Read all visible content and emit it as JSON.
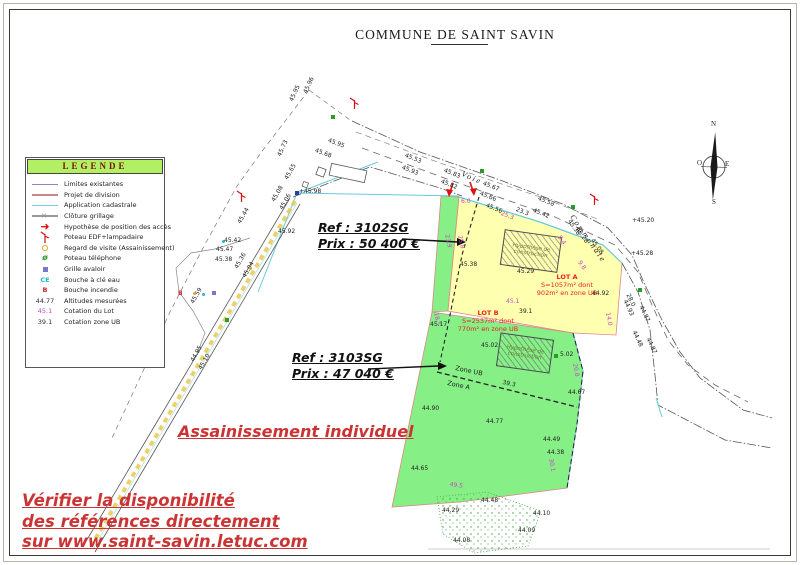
{
  "title": "COMMUNE DE SAINT SAVIN",
  "colors": {
    "lot_a_fill": "#ffffb0",
    "lot_b_fill": "#86ef86",
    "legend_header_bg": "#b2ef62",
    "annotation_red": "#cc3333",
    "lot_label_red": "#ee2020",
    "dimension_magenta": "#c44ac4",
    "cadastre_cyan": "#66ccdd",
    "division_pink": "#dd8888"
  },
  "legend": {
    "header": "LEGENDE",
    "items": [
      {
        "label": "Limites existantes",
        "symbol": "line",
        "color": "#8888bb"
      },
      {
        "label": "Projet de division",
        "symbol": "line",
        "color": "#cc8888"
      },
      {
        "label": "Application cadastrale",
        "symbol": "line",
        "color": "#7accd6"
      },
      {
        "label": "Clôture grillage",
        "symbol": "fence",
        "color": "#999999"
      },
      {
        "label": "Hypothèse de position des accès",
        "symbol": "arrow",
        "color": "#dd1111"
      },
      {
        "label": "Poteau EDF+lampadaire",
        "symbol": "pole",
        "color": "#dd1111"
      },
      {
        "label": "Regard de visite (Assainissement)",
        "symbol": "circle",
        "color": "#d9a927"
      },
      {
        "label": "Poteau téléphone",
        "symbol": "phone-pole",
        "color": "#2a9a2a"
      },
      {
        "label": "Grille avaloir",
        "symbol": "square",
        "color": "#7878cc"
      },
      {
        "label": "Bouche à clé eau",
        "symbol": "text-CE",
        "color": "#22b6cc",
        "glyph": "CE"
      },
      {
        "label": "Bouche incendie",
        "symbol": "hydrant",
        "color": "#cc2222",
        "glyph": "B"
      },
      {
        "label": "Altitudes mesurées",
        "symbol": "text",
        "color": "#333333",
        "glyph": "44.77"
      },
      {
        "label": "Cotation du Lot",
        "symbol": "text",
        "color": "#c44ac4",
        "glyph": "45.1"
      },
      {
        "label": "Cotation zone UB",
        "symbol": "text",
        "color": "#333333",
        "glyph": "39.1"
      }
    ]
  },
  "annotations": {
    "ref_a": {
      "ref": "Ref : 3102SG",
      "price": "Prix : 50 400 €"
    },
    "ref_b": {
      "ref": "Ref : 3103SG",
      "price": "Prix : 47 040 €"
    },
    "sanitation": "Assainissement individuel",
    "disclaimer_lines": [
      "Vérifier la disponibilité",
      "des références directement",
      "sur www.saint-savin.letuc.com"
    ]
  },
  "lots": {
    "lot_a": {
      "name": "LOT A",
      "line2": "S=1057m² dont",
      "line3": "902m² en zone UB"
    },
    "lot_b": {
      "name": "LOT B",
      "line2": "S=2537m² dont",
      "line3": "770m² en zone UB"
    },
    "construction_label": "Hypothèse de construction"
  },
  "map": {
    "labels": [
      {
        "t": "45.95",
        "x": 289,
        "y": 100,
        "r": -65
      },
      {
        "t": "45.96",
        "x": 303,
        "y": 92,
        "r": -65
      },
      {
        "t": "45.73",
        "x": 277,
        "y": 155,
        "r": -65
      },
      {
        "t": "45.68",
        "x": 316,
        "y": 148,
        "r": 20
      },
      {
        "t": "45.95",
        "x": 329,
        "y": 138,
        "r": 20
      },
      {
        "t": "45.53",
        "x": 406,
        "y": 153,
        "r": 22
      },
      {
        "t": "45.93",
        "x": 403,
        "y": 165,
        "r": 22
      },
      {
        "t": "45.83",
        "x": 445,
        "y": 168,
        "r": 22
      },
      {
        "t": "45.82",
        "x": 442,
        "y": 179,
        "r": 22
      },
      {
        "t": "45.67",
        "x": 484,
        "y": 181,
        "r": 22
      },
      {
        "t": "45.66",
        "x": 481,
        "y": 191,
        "r": 22
      },
      {
        "t": "45.58",
        "x": 539,
        "y": 196,
        "r": 22
      },
      {
        "t": "45.42",
        "x": 534,
        "y": 208,
        "r": 22
      },
      {
        "t": "23.3",
        "x": 517,
        "y": 207,
        "r": 22
      },
      {
        "t": "25.3",
        "x": 502,
        "y": 211,
        "r": 22,
        "c": "m"
      },
      {
        "t": "45.56",
        "x": 487,
        "y": 203,
        "r": 22
      },
      {
        "t": "6.0",
        "x": 461,
        "y": 199,
        "r": 0,
        "c": "m"
      },
      {
        "t": "Voie",
        "x": 463,
        "y": 171,
        "r": 24,
        "cls": "road"
      },
      {
        "t": "Communale",
        "x": 574,
        "y": 214,
        "r": 55,
        "cls": "road"
      },
      {
        "t": "45.44",
        "x": 237,
        "y": 222,
        "r": -60
      },
      {
        "t": "45.42",
        "x": 224,
        "y": 238,
        "r": 0
      },
      {
        "t": "45.47",
        "x": 216,
        "y": 247,
        "r": 0
      },
      {
        "t": "45.38",
        "x": 215,
        "y": 257,
        "r": 0
      },
      {
        "t": "45.92",
        "x": 278,
        "y": 229,
        "r": 0
      },
      {
        "t": "45.36",
        "x": 234,
        "y": 267,
        "r": -60
      },
      {
        "t": "45.04",
        "x": 242,
        "y": 276,
        "r": -60
      },
      {
        "t": "45.59",
        "x": 190,
        "y": 302,
        "r": -60
      },
      {
        "t": "44.95",
        "x": 190,
        "y": 360,
        "r": -60
      },
      {
        "t": "45.10",
        "x": 198,
        "y": 368,
        "r": -60
      },
      {
        "t": "45.65",
        "x": 284,
        "y": 178,
        "r": -60
      },
      {
        "t": "+45.98",
        "x": 299,
        "y": 189,
        "r": 0
      },
      {
        "t": "45.08",
        "x": 271,
        "y": 200,
        "r": -60
      },
      {
        "t": "45.06",
        "x": 279,
        "y": 208,
        "r": -60
      },
      {
        "t": "45.38",
        "x": 571,
        "y": 219,
        "r": 55
      },
      {
        "t": "45.28",
        "x": 579,
        "y": 227,
        "r": 55
      },
      {
        "t": "45.08",
        "x": 594,
        "y": 238,
        "r": 55
      },
      {
        "t": "+45.20",
        "x": 632,
        "y": 218,
        "r": 0
      },
      {
        "t": "+45.28",
        "x": 631,
        "y": 251,
        "r": 0
      },
      {
        "t": "9.4",
        "x": 561,
        "y": 235,
        "r": 55,
        "c": "m"
      },
      {
        "t": "9.8",
        "x": 581,
        "y": 260,
        "r": 55,
        "c": "m"
      },
      {
        "t": "44.92",
        "x": 592,
        "y": 291,
        "r": 0
      },
      {
        "t": "14.0",
        "x": 610,
        "y": 312,
        "r": 80,
        "c": "m"
      },
      {
        "t": "28.0",
        "x": 630,
        "y": 293,
        "r": 65
      },
      {
        "t": "44.93",
        "x": 627,
        "y": 299,
        "r": 65
      },
      {
        "t": "44.87",
        "x": 643,
        "y": 305,
        "r": 65
      },
      {
        "t": "44.48",
        "x": 636,
        "y": 330,
        "r": 65
      },
      {
        "t": "44.87",
        "x": 650,
        "y": 337,
        "r": 65
      },
      {
        "t": "23.9",
        "x": 449,
        "y": 234,
        "r": 78,
        "c": "m"
      },
      {
        "t": "25.8",
        "x": 462,
        "y": 235,
        "r": 78,
        "c": "m"
      },
      {
        "t": "45.38",
        "x": 460,
        "y": 262,
        "r": 0
      },
      {
        "t": "45.29",
        "x": 517,
        "y": 269,
        "r": 0
      },
      {
        "t": "45.1",
        "x": 506,
        "y": 299,
        "r": 0,
        "c": "m"
      },
      {
        "t": "39.1",
        "x": 519,
        "y": 309,
        "r": 0
      },
      {
        "t": "45.17",
        "x": 430,
        "y": 322,
        "r": 0
      },
      {
        "t": "18.5",
        "x": 438,
        "y": 312,
        "r": 78,
        "c": "m"
      },
      {
        "t": "45.02",
        "x": 481,
        "y": 343,
        "r": 0
      },
      {
        "t": "5.02",
        "x": 560,
        "y": 352,
        "r": 0
      },
      {
        "t": "Zone UB",
        "x": 456,
        "y": 365,
        "r": 12,
        "cls": "zone"
      },
      {
        "t": "Zone A",
        "x": 448,
        "y": 380,
        "r": 12,
        "cls": "zone"
      },
      {
        "t": "39.3",
        "x": 503,
        "y": 380,
        "r": 12
      },
      {
        "t": "44.90",
        "x": 422,
        "y": 406,
        "r": 0
      },
      {
        "t": "44.77",
        "x": 486,
        "y": 419,
        "r": 0
      },
      {
        "t": "44.49",
        "x": 543,
        "y": 437,
        "r": 0
      },
      {
        "t": "44.38",
        "x": 547,
        "y": 450,
        "r": 0
      },
      {
        "t": "30.1",
        "x": 553,
        "y": 458,
        "r": 80,
        "c": "m"
      },
      {
        "t": "44.65",
        "x": 411,
        "y": 466,
        "r": 0
      },
      {
        "t": "49.5",
        "x": 450,
        "y": 482,
        "r": 8,
        "c": "m"
      },
      {
        "t": "44.67",
        "x": 568,
        "y": 390,
        "r": 0
      },
      {
        "t": "20.8",
        "x": 577,
        "y": 363,
        "r": 80,
        "c": "m"
      },
      {
        "t": "44.48",
        "x": 481,
        "y": 498,
        "r": 0
      },
      {
        "t": "44.29",
        "x": 442,
        "y": 508,
        "r": 0
      },
      {
        "t": "44.10",
        "x": 533,
        "y": 511,
        "r": 0
      },
      {
        "t": "44.09",
        "x": 518,
        "y": 528,
        "r": 0
      },
      {
        "t": "44.08",
        "x": 453,
        "y": 538,
        "r": 0
      },
      {
        "t": "N",
        "x": 711,
        "y": 121,
        "r": 0,
        "cls": "compass"
      },
      {
        "t": "S",
        "x": 712,
        "y": 199,
        "r": 0,
        "cls": "compass"
      },
      {
        "t": "O",
        "x": 697,
        "y": 160,
        "r": 0,
        "cls": "compass"
      },
      {
        "t": "E",
        "x": 725,
        "y": 161,
        "r": 0,
        "cls": "compass"
      }
    ],
    "markers": [
      {
        "type": "pole",
        "x": 349,
        "y": 97
      },
      {
        "type": "pole",
        "x": 236,
        "y": 190
      },
      {
        "type": "pole",
        "x": 589,
        "y": 193
      },
      {
        "type": "tel",
        "x": 331,
        "y": 115
      },
      {
        "type": "tel",
        "x": 480,
        "y": 169
      },
      {
        "type": "tel",
        "x": 571,
        "y": 205
      },
      {
        "type": "tel",
        "x": 638,
        "y": 288
      },
      {
        "type": "tel",
        "x": 225,
        "y": 318
      },
      {
        "type": "tel",
        "x": 554,
        "y": 354
      },
      {
        "type": "water",
        "x": 222,
        "y": 240
      },
      {
        "type": "water",
        "x": 202,
        "y": 293
      },
      {
        "type": "regard",
        "x": 193,
        "y": 292
      },
      {
        "type": "regard",
        "x": 249,
        "y": 267
      },
      {
        "type": "grille",
        "x": 212,
        "y": 291
      },
      {
        "type": "hydrant",
        "x": 178,
        "y": 292,
        "glyph": "B"
      },
      {
        "type": "bluedot",
        "x": 295,
        "y": 191
      }
    ]
  }
}
